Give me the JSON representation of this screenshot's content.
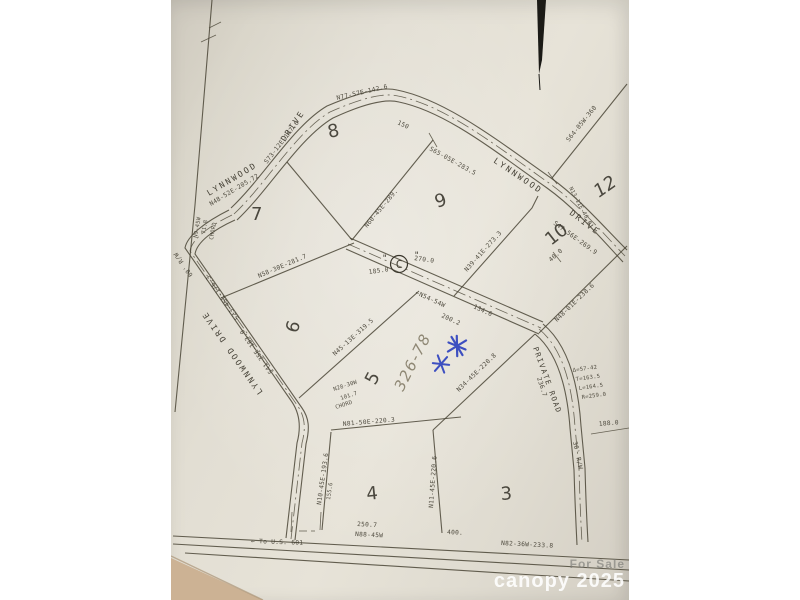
{
  "photo": {
    "streets": {
      "lynnwood_nw": "LYNNWOOD",
      "drive_nw": "DRIVE",
      "lynnwood_ne": "LYNNWOOD",
      "drive_ne": "DRIVE",
      "lynnwood_w": "LYNNWOOD DRIVE",
      "private_road": "PRIVATE ROAD",
      "rw_30": "30' R/W",
      "rw_60": "60' R/W",
      "to_us_601": "← To U.S. 601"
    },
    "lots": {
      "lot3": "3",
      "lot4": "4",
      "lot5": "5",
      "lot6": "6",
      "lot7": "7",
      "lot8": "8",
      "lot9": "9",
      "lot10": "10",
      "lot12": "12"
    },
    "curve_point": {
      "label": "C",
      "quote": "\""
    },
    "bearings": [
      "N77-57E-142.6",
      "150",
      "S65-05E-283.5",
      "N60-45E-289.",
      "N48-52E-205.72",
      "S73-12E-147.6",
      "N9-45W",
      "71.8",
      "CHORD",
      "N58-30E-281.7",
      "S23-45E-176.3",
      "S41-35E-183.0",
      "N39-41E-273.3",
      "S47-56E-269.9",
      "N13-11E-46.0",
      "S64-05W-360",
      "N48-01E-238.6",
      "270.0",
      "185.0",
      "←N54-54W",
      "134.6",
      "200.2",
      "N45-13E-319.5",
      "N28-30W",
      "101.7",
      "CHORD",
      "N81-50E-220.3",
      "N34-45E-220.8",
      "N10-45E-193.6",
      "155.6",
      "N11-45E-220.6",
      "250.7",
      "N88-45W",
      "400.",
      "N82-36W-233.8",
      "Δ=57-42",
      "T=163.5",
      "L=164.5",
      "R=259.0",
      "236.7",
      "188.0",
      "40.0"
    ],
    "annotations": {
      "pencil_note": "326-78"
    },
    "icons": {
      "blue_star_glyph": "✳"
    },
    "watermark": {
      "line1": "For Sale",
      "line2": "canopy 2025"
    },
    "colors": {
      "ink": "#413d31",
      "blue_ink": "#2b3fbe",
      "pencil": "#857d69",
      "paper": "#e3dfd4"
    }
  }
}
